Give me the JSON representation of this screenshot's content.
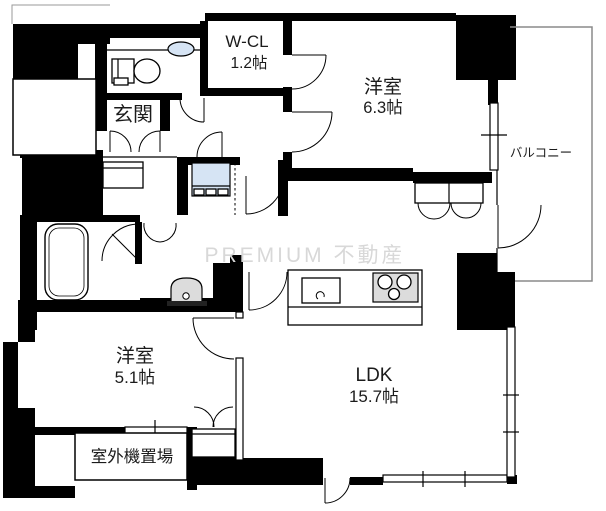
{
  "floor_plan": {
    "watermark": "PREMIUM 不動産",
    "rooms": {
      "entrance": {
        "label": "玄関"
      },
      "walk_in_closet": {
        "label": "W-CL",
        "size": "1.2帖"
      },
      "bedroom_63": {
        "label": "洋室",
        "size": "6.3帖"
      },
      "balcony": {
        "label": "バルコニー"
      },
      "bedroom_51": {
        "label": "洋室",
        "size": "5.1帖"
      },
      "ldk": {
        "label": "LDK",
        "size": "15.7帖"
      },
      "outdoor_unit_space": {
        "label": "室外機置場"
      }
    },
    "colors": {
      "wall": "#000000",
      "fixture_blue": "#d6e4f4",
      "fixture_gray": "#dcdcdc",
      "watermark_gray": "#d8d8d8"
    }
  }
}
